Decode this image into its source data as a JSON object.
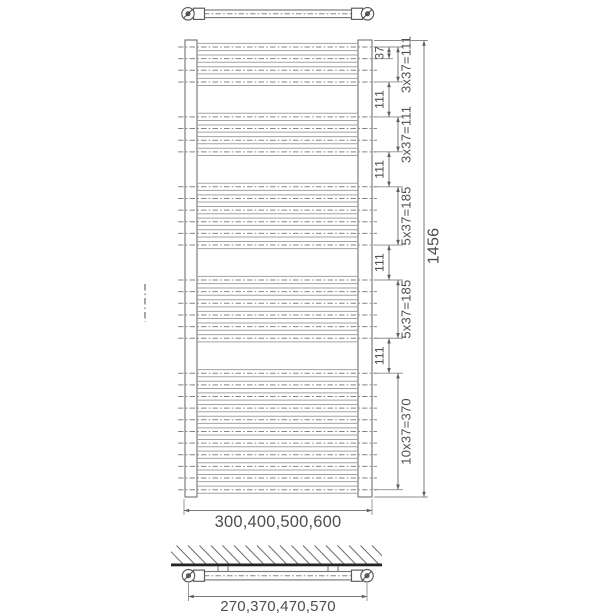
{
  "drawing": {
    "type": "technical-dimension-drawing",
    "subject": "heated towel rail radiator",
    "views": {
      "top": "top view of rail with end caps",
      "front": "front view with rung groups",
      "bottom": "wall mounting section view"
    },
    "dimensions": {
      "overall_height": "1456",
      "width_options": "300,400,500,600",
      "bracket_spacing_options": "270,370,470,570",
      "rung_pitch": "37",
      "group_gap": "111",
      "gaps": [
        "111",
        "111",
        "111",
        "111"
      ],
      "groups": [
        {
          "rungs": 4,
          "label": "3x37=111"
        },
        {
          "rungs": 4,
          "label": "3x37=111"
        },
        {
          "rungs": 6,
          "label": "5x37=185"
        },
        {
          "rungs": 6,
          "label": "5x37=185"
        },
        {
          "rungs": 11,
          "label": "10x37=370"
        }
      ]
    },
    "colors": {
      "background": "#ffffff",
      "line": "#787878",
      "rung_line": "#a2a2a2",
      "dash": "#868686",
      "text": "#4e4e4e",
      "wall": "#232323"
    }
  }
}
